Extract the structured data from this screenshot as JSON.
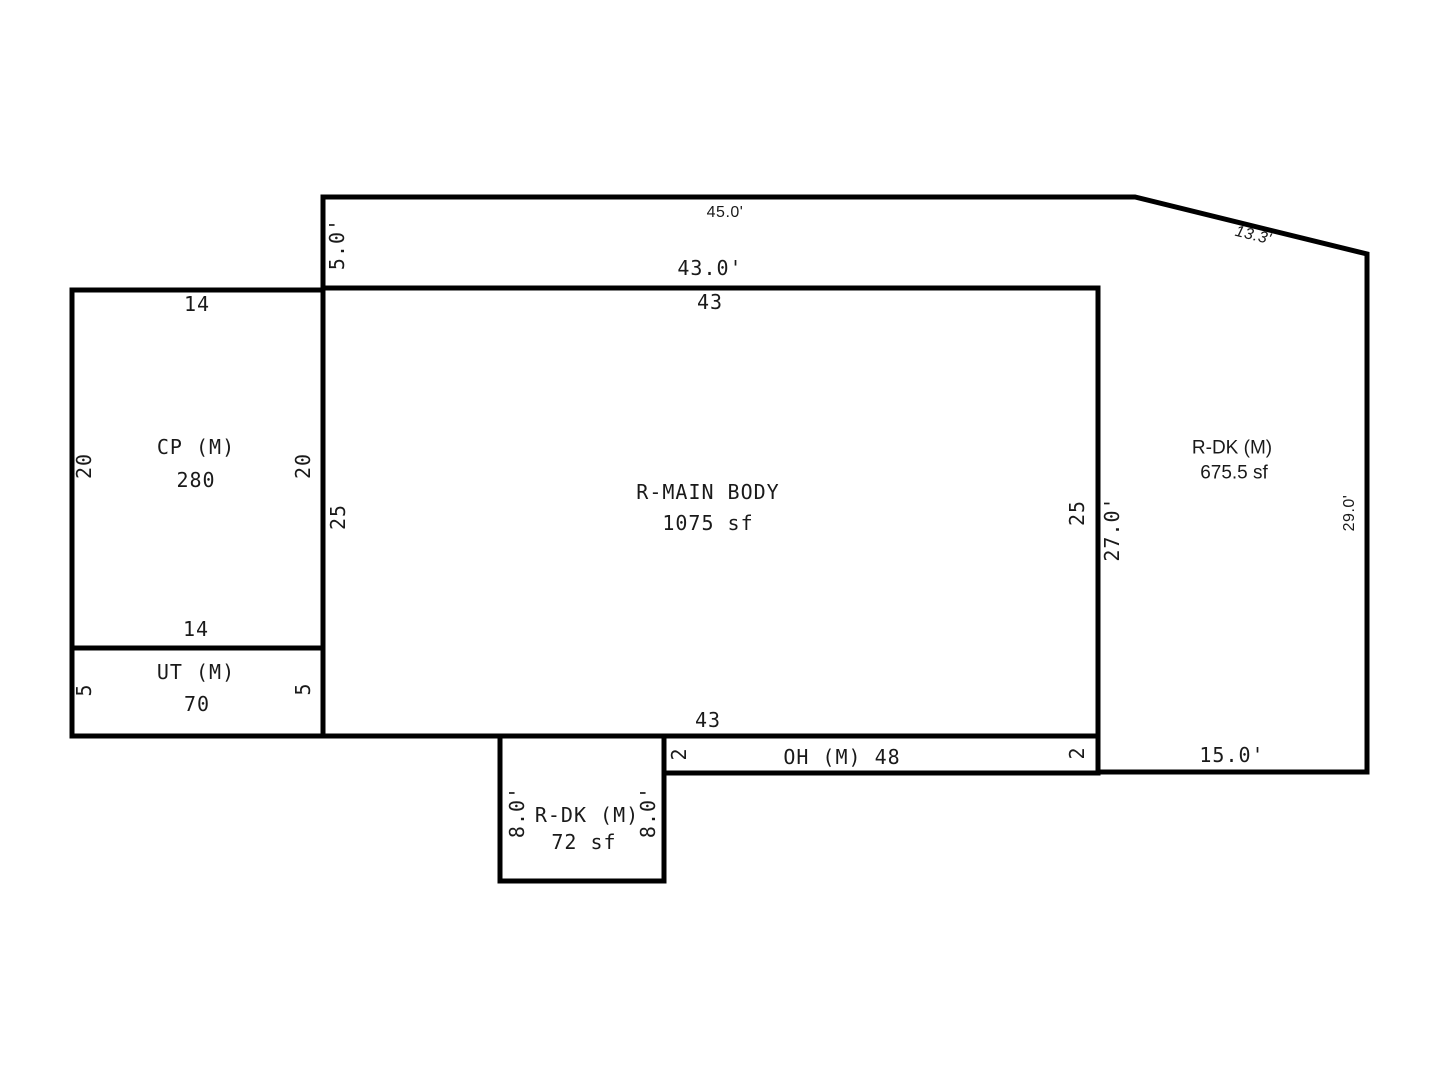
{
  "diagram": {
    "kind": "property-sketch-floor-plan",
    "background_color": "#ffffff",
    "line_color": "#000000",
    "text_color": "#1a1a1a"
  },
  "rooms": {
    "main_body": {
      "name": "R-MAIN BODY",
      "area": "1075 sf"
    },
    "carport": {
      "name": "CP (M)",
      "area": "280"
    },
    "utility": {
      "name": "UT (M)",
      "area": "70"
    },
    "rear_deck_large": {
      "name": "R-DK (M)",
      "area": "675.5 sf"
    },
    "rear_deck_small": {
      "name": "R-DK (M)",
      "area": "72 sf"
    },
    "overhang": {
      "name": "OH (M) 48"
    }
  },
  "dimensions": {
    "outer_top": "45.0'",
    "outer_left": "5.0'",
    "outer_diagonal": "13.3'",
    "outer_right": "29.0'",
    "outer_bottom": "15.0'",
    "main_top_feet": "43.0'",
    "main_top": "43",
    "main_bottom": "43",
    "main_left": "25",
    "main_right": "25",
    "main_right_outer": "27.0'",
    "carport_top": "14",
    "carport_bottom": "14",
    "carport_left": "20",
    "carport_right": "20",
    "utility_left": "5",
    "utility_right": "5",
    "overhang_left": "2",
    "overhang_right": "2",
    "deck_small_left": "8.0'",
    "deck_small_right": "8.0'"
  }
}
